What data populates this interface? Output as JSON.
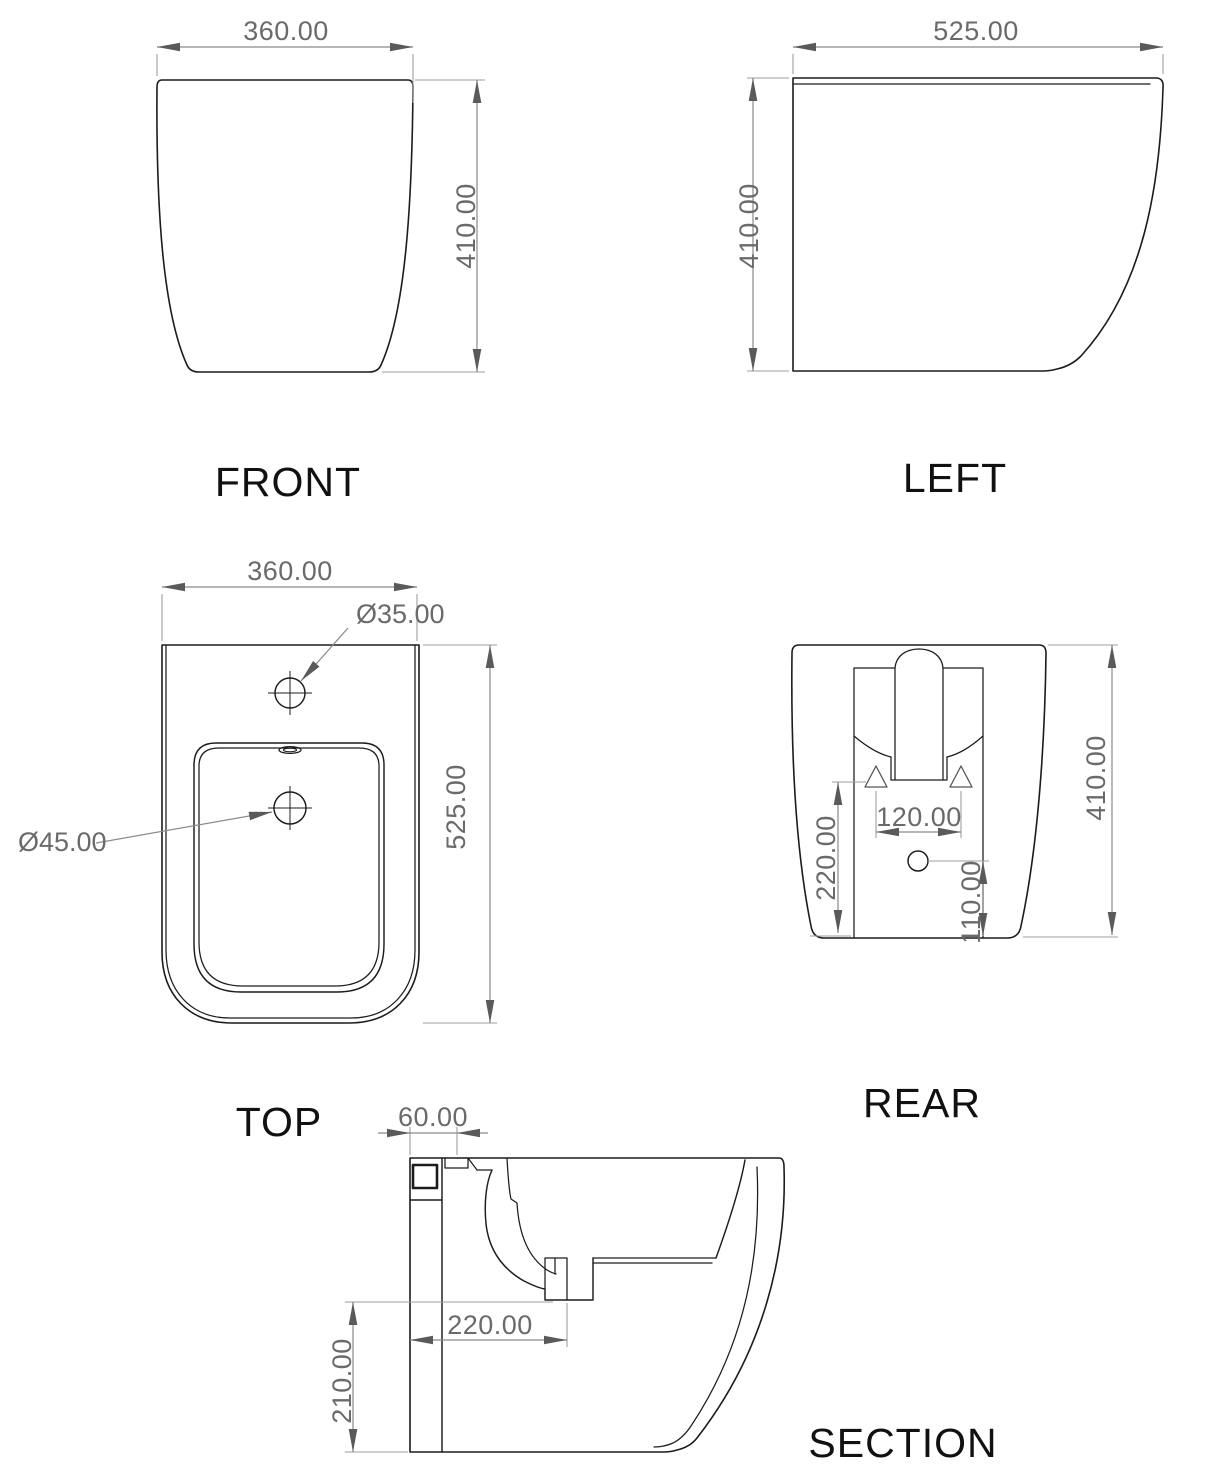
{
  "drawing": {
    "title": "Bidet multi-view technical drawing",
    "accent_color": "#1c1c1c",
    "dim_color": "#6a6a6a"
  },
  "views": {
    "front": {
      "label": "FRONT",
      "width": "360.00",
      "height": "410.00"
    },
    "left": {
      "label": "LEFT",
      "depth": "525.00",
      "height": "410.00"
    },
    "top": {
      "label": "TOP",
      "width": "360.00",
      "depth": "525.00",
      "faucet_hole": "Ø35.00",
      "drain_hole": "Ø45.00"
    },
    "rear": {
      "label": "REAR",
      "height": "410.00",
      "fixing_spacing": "120.00",
      "trap_height": "220.00",
      "inlet_height": "110.00"
    },
    "section": {
      "label": "SECTION",
      "faucet_offset": "60.00",
      "drain_offset": "220.00",
      "outlet_height": "210.00"
    }
  }
}
